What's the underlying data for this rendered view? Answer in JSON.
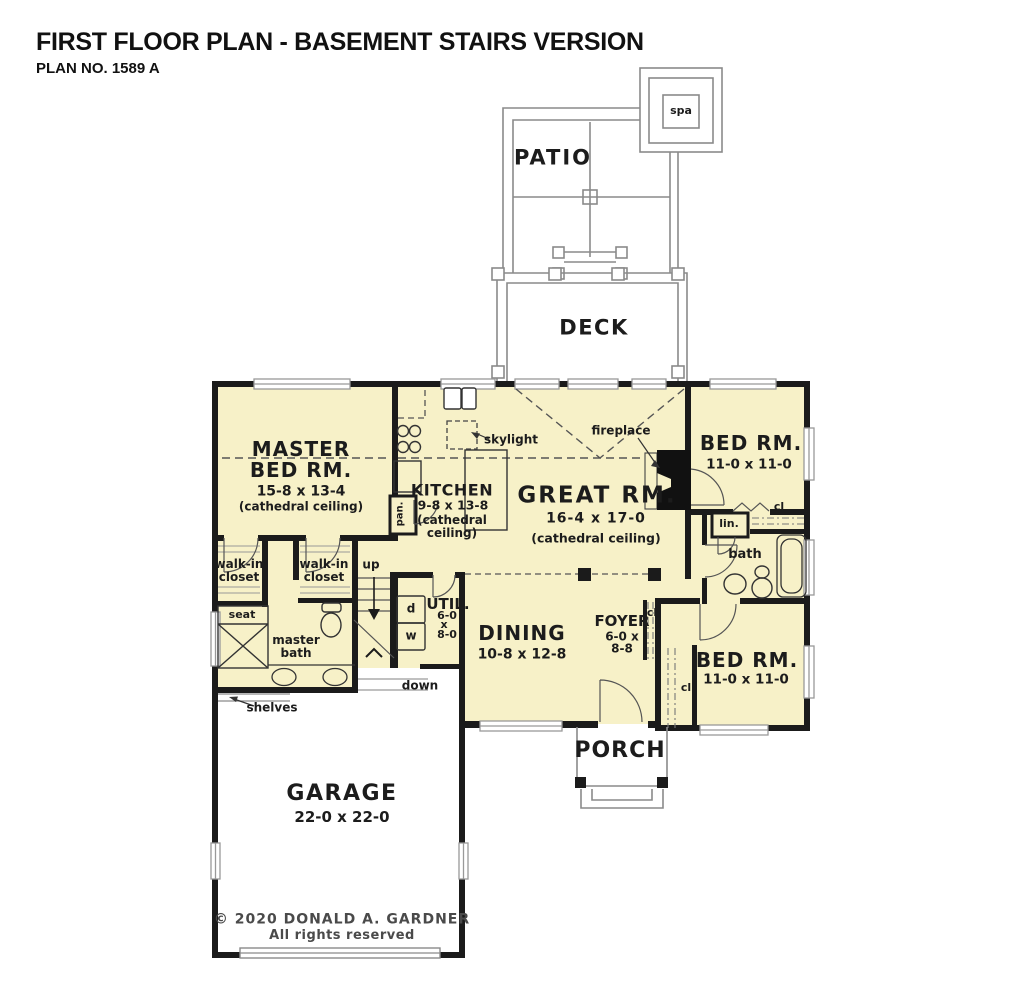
{
  "header": {
    "title": "FIRST FLOOR PLAN - BASEMENT STAIRS VERSION",
    "plan_no": "PLAN NO. 1589 A"
  },
  "outdoor": {
    "patio": "PATIO",
    "spa": "spa",
    "deck": "DECK",
    "porch": "PORCH"
  },
  "rooms": {
    "master_bed": {
      "name_line1": "MASTER",
      "name_line2": "BED RM.",
      "dims": "15-8 x 13-4",
      "note": "(cathedral ceiling)"
    },
    "kitchen": {
      "name": "KITCHEN",
      "dims": "9-8 x 13-8",
      "note": "(cathedral ceiling)"
    },
    "great_rm": {
      "name": "GREAT RM.",
      "dims": "16-4 x 17-0",
      "note": "(cathedral ceiling)"
    },
    "bed_rm_upper": {
      "name": "BED RM.",
      "dims": "11-0 x 11-0"
    },
    "bed_rm_lower": {
      "name": "BED RM.",
      "dims": "11-0 x 11-0"
    },
    "dining": {
      "name": "DINING",
      "dims": "10-8 x 12-8"
    },
    "foyer": {
      "name": "FOYER",
      "dims_line1": "6-0 x",
      "dims_line2": "8-8"
    },
    "util": {
      "name": "UTIL.",
      "dims_line1": "6-0",
      "dims_line2": "x",
      "dims_line3": "8-0"
    },
    "garage": {
      "name": "GARAGE",
      "dims": "22-0 x 22-0"
    }
  },
  "annotations": {
    "skylight": "skylight",
    "fireplace": "fireplace",
    "pantry": "pan.",
    "up": "up",
    "down": "down",
    "dryer": "d",
    "washer": "w",
    "walk_in_closet": "walk-in closet",
    "seat": "seat",
    "master_bath": "master bath",
    "shelves": "shelves",
    "linen": "lin.",
    "bath": "bath",
    "closet": "cl"
  },
  "footer": {
    "copyright": "© 2020 DONALD A. GARDNER",
    "rights": "All rights reserved"
  },
  "colors": {
    "room_fill": "#f7f1c8",
    "wall": "#1b1b1b",
    "site_line": "#8a8a8a",
    "dashed_line": "#555555",
    "copyright_text": "#4a4a4a"
  }
}
